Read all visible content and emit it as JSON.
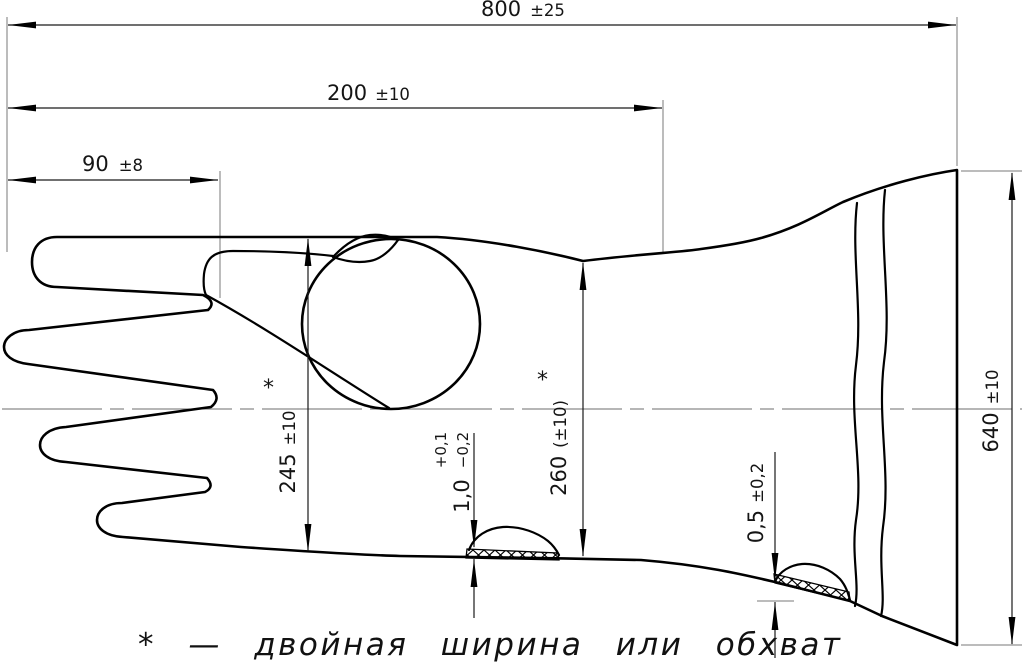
{
  "drawing": {
    "title_hint": "glove technical drawing",
    "line_color": "#000000",
    "background": "#ffffff",
    "dims": {
      "overall_length": {
        "value": "800",
        "tol": "±25"
      },
      "gauntlet_length": {
        "value": "200",
        "tol": "±10"
      },
      "finger_length": {
        "value": "90",
        "tol": "±8"
      },
      "palm_double_width": {
        "value": "245",
        "tol": "±10",
        "ref": "*"
      },
      "wrist_double_width": {
        "value": "260",
        "tol": "(±10)",
        "ref": "*"
      },
      "palm_bead_thickness": {
        "value": "1,0",
        "tol_plus": "+0,1",
        "tol_minus": "−0,2"
      },
      "cuff_bead_thickness": {
        "value": "0,5",
        "tol": "±0,2"
      },
      "cuff_double_width": {
        "value": "640",
        "tol": "±10"
      }
    },
    "footnote": "* — двойная ширина или обхват"
  }
}
